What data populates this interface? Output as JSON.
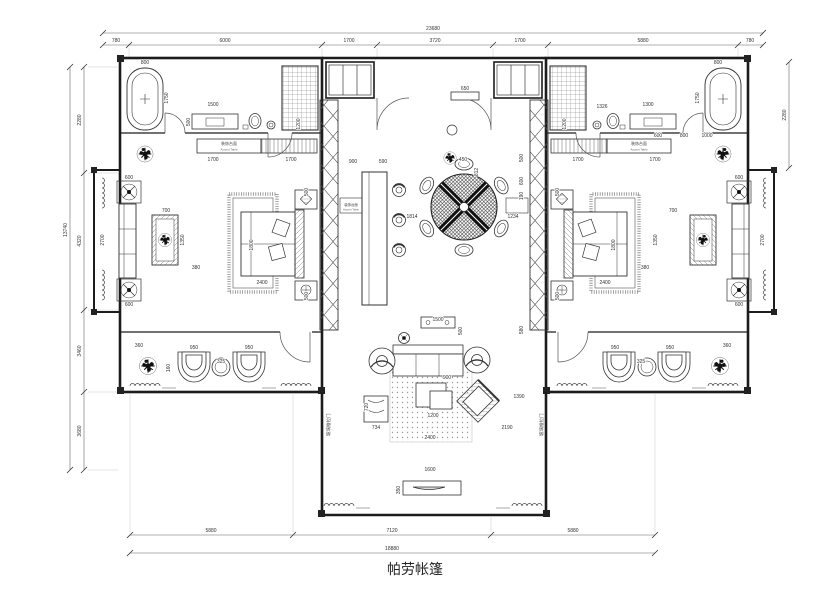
{
  "title": "帕劳帐篷",
  "drawing": {
    "type": "floor-plan",
    "labels": {
      "accent_table_cn": "装饰台面",
      "accent_table_en": "Accent Table",
      "sliding_door": "玻璃推拉门"
    },
    "dimensions": {
      "top_total": "23680",
      "top_segments": [
        "780",
        "6000",
        "1700",
        "3720",
        "1700",
        "5880",
        "780"
      ],
      "bottom_segments": [
        "5880",
        "7120",
        "5880"
      ],
      "bottom_total": "18880",
      "left_segments": [
        "2280",
        "4320",
        "3460",
        "3680"
      ],
      "left_total": "13740",
      "right_side": "2280"
    },
    "annotations": [
      {
        "x": 433,
        "y": 30,
        "t": "23680"
      },
      {
        "x": 116,
        "y": 42,
        "t": "780"
      },
      {
        "x": 225,
        "y": 42,
        "t": "6000"
      },
      {
        "x": 349,
        "y": 42,
        "t": "1700"
      },
      {
        "x": 435,
        "y": 42,
        "t": "3720"
      },
      {
        "x": 520,
        "y": 42,
        "t": "1700"
      },
      {
        "x": 643,
        "y": 42,
        "t": "5880"
      },
      {
        "x": 750,
        "y": 42,
        "t": "780"
      },
      {
        "x": 211,
        "y": 532,
        "t": "5880"
      },
      {
        "x": 392,
        "y": 532,
        "t": "7120"
      },
      {
        "x": 573,
        "y": 532,
        "t": "5880"
      },
      {
        "x": 392,
        "y": 550,
        "t": "18880"
      },
      {
        "x": 67,
        "y": 230,
        "r": -90,
        "t": "13740"
      },
      {
        "x": 81,
        "y": 120,
        "r": -90,
        "t": "2280"
      },
      {
        "x": 81,
        "y": 241,
        "r": -90,
        "t": "4320"
      },
      {
        "x": 81,
        "y": 351,
        "r": -90,
        "t": "3460"
      },
      {
        "x": 81,
        "y": 431,
        "r": -90,
        "t": "3680"
      },
      {
        "x": 786,
        "y": 115,
        "r": -90,
        "t": "2280"
      },
      {
        "x": 145,
        "y": 64,
        "t": "800"
      },
      {
        "x": 168,
        "y": 98,
        "r": -90,
        "t": "1750"
      },
      {
        "x": 213,
        "y": 106,
        "t": "1500"
      },
      {
        "x": 190,
        "y": 122,
        "r": -90,
        "t": "500"
      },
      {
        "x": 300,
        "y": 124,
        "r": -90,
        "t": "1200"
      },
      {
        "x": 213,
        "y": 161,
        "t": "1700"
      },
      {
        "x": 291,
        "y": 161,
        "t": "1700"
      },
      {
        "x": 253,
        "y": 245,
        "r": -90,
        "t": "1800"
      },
      {
        "x": 262,
        "y": 284,
        "t": "2400"
      },
      {
        "x": 308,
        "y": 192,
        "r": -90,
        "t": "500"
      },
      {
        "x": 308,
        "y": 296,
        "r": -90,
        "t": "500"
      },
      {
        "x": 104,
        "y": 240,
        "r": -90,
        "t": "2700"
      },
      {
        "x": 129,
        "y": 179,
        "t": "600"
      },
      {
        "x": 129,
        "y": 306,
        "t": "600"
      },
      {
        "x": 166,
        "y": 212,
        "t": "700"
      },
      {
        "x": 184,
        "y": 240,
        "r": -90,
        "t": "1350"
      },
      {
        "x": 196,
        "y": 269,
        "t": "380"
      },
      {
        "x": 139,
        "y": 347,
        "t": "360"
      },
      {
        "x": 194,
        "y": 349,
        "t": "950"
      },
      {
        "x": 249,
        "y": 349,
        "t": "950"
      },
      {
        "x": 221,
        "y": 363,
        "t": "325"
      },
      {
        "x": 170,
        "y": 368,
        "r": -90,
        "t": "160"
      },
      {
        "x": 718,
        "y": 64,
        "t": "800"
      },
      {
        "x": 699,
        "y": 98,
        "r": -90,
        "t": "1750"
      },
      {
        "x": 648,
        "y": 106,
        "t": "1300"
      },
      {
        "x": 602,
        "y": 108,
        "t": "1326"
      },
      {
        "x": 566,
        "y": 124,
        "r": -90,
        "t": "1200"
      },
      {
        "x": 578,
        "y": 161,
        "t": "1700"
      },
      {
        "x": 655,
        "y": 161,
        "t": "1700"
      },
      {
        "x": 658,
        "y": 137,
        "t": "600"
      },
      {
        "x": 684,
        "y": 137,
        "t": "800"
      },
      {
        "x": 707,
        "y": 137,
        "t": "1000"
      },
      {
        "x": 615,
        "y": 245,
        "r": -90,
        "t": "1800"
      },
      {
        "x": 605,
        "y": 284,
        "t": "2400"
      },
      {
        "x": 559,
        "y": 192,
        "r": -90,
        "t": "500"
      },
      {
        "x": 559,
        "y": 296,
        "r": -90,
        "t": "500"
      },
      {
        "x": 764,
        "y": 240,
        "r": -90,
        "t": "2700"
      },
      {
        "x": 739,
        "y": 179,
        "t": "600"
      },
      {
        "x": 739,
        "y": 306,
        "t": "600"
      },
      {
        "x": 673,
        "y": 212,
        "t": "700"
      },
      {
        "x": 657,
        "y": 240,
        "r": -90,
        "t": "1350"
      },
      {
        "x": 645,
        "y": 269,
        "t": "380"
      },
      {
        "x": 727,
        "y": 347,
        "t": "360"
      },
      {
        "x": 615,
        "y": 349,
        "t": "950"
      },
      {
        "x": 670,
        "y": 349,
        "t": "950"
      },
      {
        "x": 641,
        "y": 363,
        "t": "325"
      },
      {
        "x": 353,
        "y": 163,
        "t": "900"
      },
      {
        "x": 383,
        "y": 163,
        "t": "590"
      },
      {
        "x": 465,
        "y": 90,
        "t": "650"
      },
      {
        "x": 463,
        "y": 161,
        "t": "450"
      },
      {
        "x": 478,
        "y": 172,
        "r": -90,
        "t": "812"
      },
      {
        "x": 412,
        "y": 218,
        "t": "1814"
      },
      {
        "x": 513,
        "y": 218,
        "t": "1234"
      },
      {
        "x": 523,
        "y": 158,
        "r": -90,
        "t": "500"
      },
      {
        "x": 523,
        "y": 181,
        "r": -90,
        "t": "600"
      },
      {
        "x": 523,
        "y": 196,
        "r": -90,
        "t": "190"
      },
      {
        "x": 523,
        "y": 330,
        "r": -90,
        "t": "580"
      },
      {
        "x": 438,
        "y": 321,
        "t": "1500"
      },
      {
        "x": 462,
        "y": 331,
        "r": -90,
        "t": "500"
      },
      {
        "x": 447,
        "y": 379,
        "t": "900"
      },
      {
        "x": 433,
        "y": 417,
        "t": "1200"
      },
      {
        "x": 430,
        "y": 439,
        "t": "2400"
      },
      {
        "x": 507,
        "y": 429,
        "t": "2190"
      },
      {
        "x": 519,
        "y": 398,
        "t": "1390"
      },
      {
        "x": 368,
        "y": 407,
        "r": -90,
        "t": "720"
      },
      {
        "x": 376,
        "y": 429,
        "t": "734"
      },
      {
        "x": 430,
        "y": 471,
        "t": "1600"
      },
      {
        "x": 400,
        "y": 490,
        "r": -90,
        "t": "350"
      }
    ]
  }
}
